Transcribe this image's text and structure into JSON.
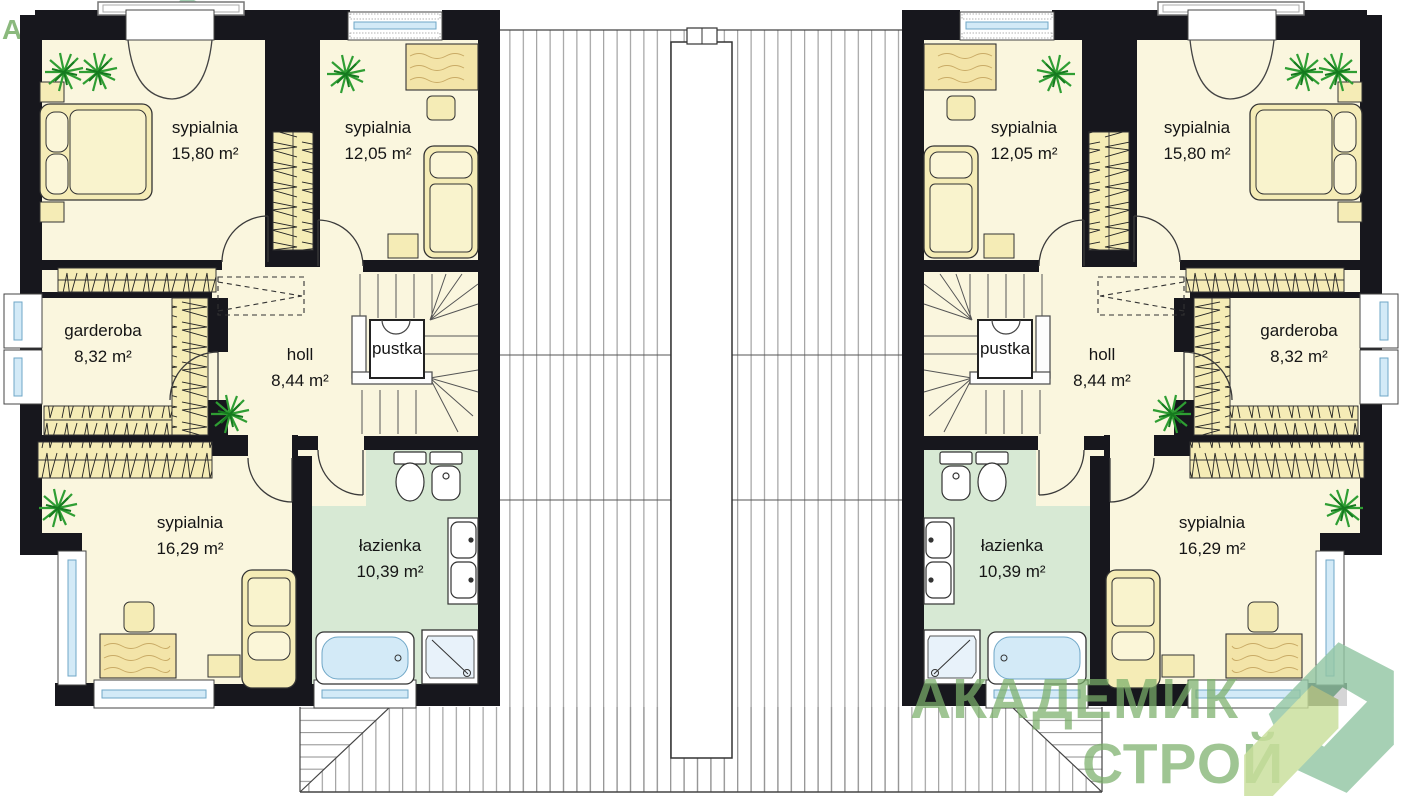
{
  "watermark": {
    "line1": "АКАДЕМИК",
    "line2": "СТРОЙ"
  },
  "units": {
    "left": {
      "rooms": [
        {
          "name": "sypialnia",
          "area": "15,80 m²"
        },
        {
          "name": "sypialnia",
          "area": "12,05 m²"
        },
        {
          "name": "garderoba",
          "area": "8,32 m²"
        },
        {
          "name": "holl",
          "area": "8,44 m²"
        },
        {
          "name": "pustka"
        },
        {
          "name": "sypialnia",
          "area": "16,29 m²"
        },
        {
          "name": "łazienka",
          "area": "10,39 m²"
        }
      ]
    },
    "right": {
      "rooms": [
        {
          "name": "sypialnia",
          "area": "15,80 m²"
        },
        {
          "name": "sypialnia",
          "area": "12,05 m²"
        },
        {
          "name": "garderoba",
          "area": "8,32 m²"
        },
        {
          "name": "holl",
          "area": "8,44 m²"
        },
        {
          "name": "pustka"
        },
        {
          "name": "sypialnia",
          "area": "16,29 m²"
        },
        {
          "name": "łazienka",
          "area": "10,39 m²"
        }
      ]
    }
  },
  "colors": {
    "wall": "#17171d",
    "floor": "#faf6de",
    "furniture": "#f5ecb6",
    "bathroom": "#d7e9d4",
    "glass": "#d3eaf7",
    "plant": "#2f9e33",
    "watermark_green": "#7ab56a",
    "logo_lime": "#c9df9b",
    "logo_teal": "#93c6a4"
  }
}
